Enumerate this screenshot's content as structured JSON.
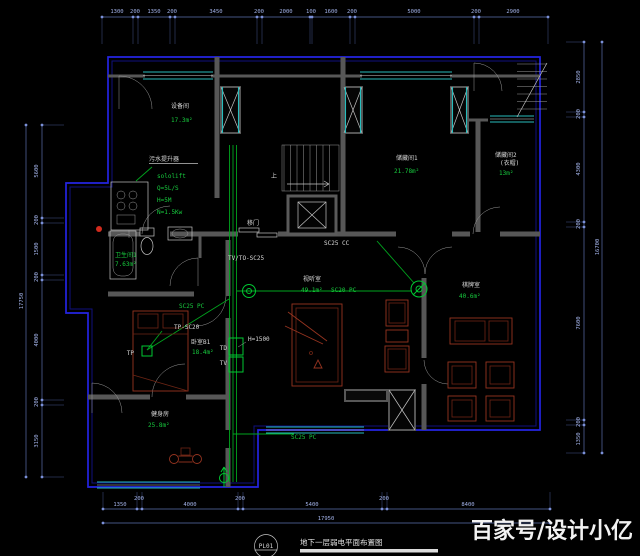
{
  "watermark": "百家号/设计小亿",
  "title_block": {
    "code": "PL01",
    "title": "地下一层弱电平面布置图"
  },
  "colors": {
    "background": "#000000",
    "wall_blue": "#2424e2",
    "window_teal": "#27bdbd",
    "wire_green": "#00c832",
    "dim_blue": "#a3b3ea",
    "furniture_red": "#963420",
    "cad_white": "#d8d8d8"
  },
  "rooms": {
    "equipment": {
      "name": "设备间",
      "area": "17.3m²"
    },
    "storage1": {
      "name": "储藏间1",
      "area": "21.78m²"
    },
    "storage2": {
      "name": "储藏间2",
      "sub": "(衣帽)",
      "area": "13m²"
    },
    "bath1": {
      "name": "卫生间1",
      "area": "7.63m²"
    },
    "av": {
      "name": "视听室",
      "area": "49.1m²"
    },
    "bedroomB1": {
      "name": "卧室B1",
      "area": "18.4m²"
    },
    "gym": {
      "name": "健身房",
      "area": "25.8m²"
    },
    "chess": {
      "name": "棋牌室",
      "area": "40.6m²"
    }
  },
  "annotations": {
    "sewage_lifter_title": "污水提升器",
    "sololift_model": "sololift",
    "sololift_q": "Q=5L/S",
    "sololift_h": "H=5M",
    "sololift_n": "N=1.5Kw",
    "sc25_cc": "SC25 CC",
    "tv_to_sc25": "TV/TO-SC25",
    "sc20_pc": "SC20 PC",
    "sc25_pc_upper": "SC25 PC",
    "sc25_pc_lower": "SC25 PC",
    "tp_sc20": "TP-SC20",
    "tp": "TP",
    "td": "TD",
    "tv": "TV",
    "h1500": "H=1500",
    "sliding_door": "移门",
    "up": "上"
  },
  "dims": {
    "top": [
      "1300",
      "200",
      "1350",
      "200",
      "3450",
      "200",
      "2000",
      "100",
      "1600",
      "200",
      "5000",
      "200",
      "2900"
    ],
    "bottom": [
      "1350",
      "200",
      "4000",
      "200",
      "5400",
      "200",
      "8400"
    ],
    "bottom_total": "17950",
    "left": [
      "5600",
      "200",
      "1500",
      "200",
      "4000",
      "200",
      "3150"
    ],
    "left_total": "17750",
    "right": [
      "2850",
      "200",
      "4300",
      "200",
      "7600",
      "200",
      "1350"
    ],
    "right_total": "16700"
  }
}
